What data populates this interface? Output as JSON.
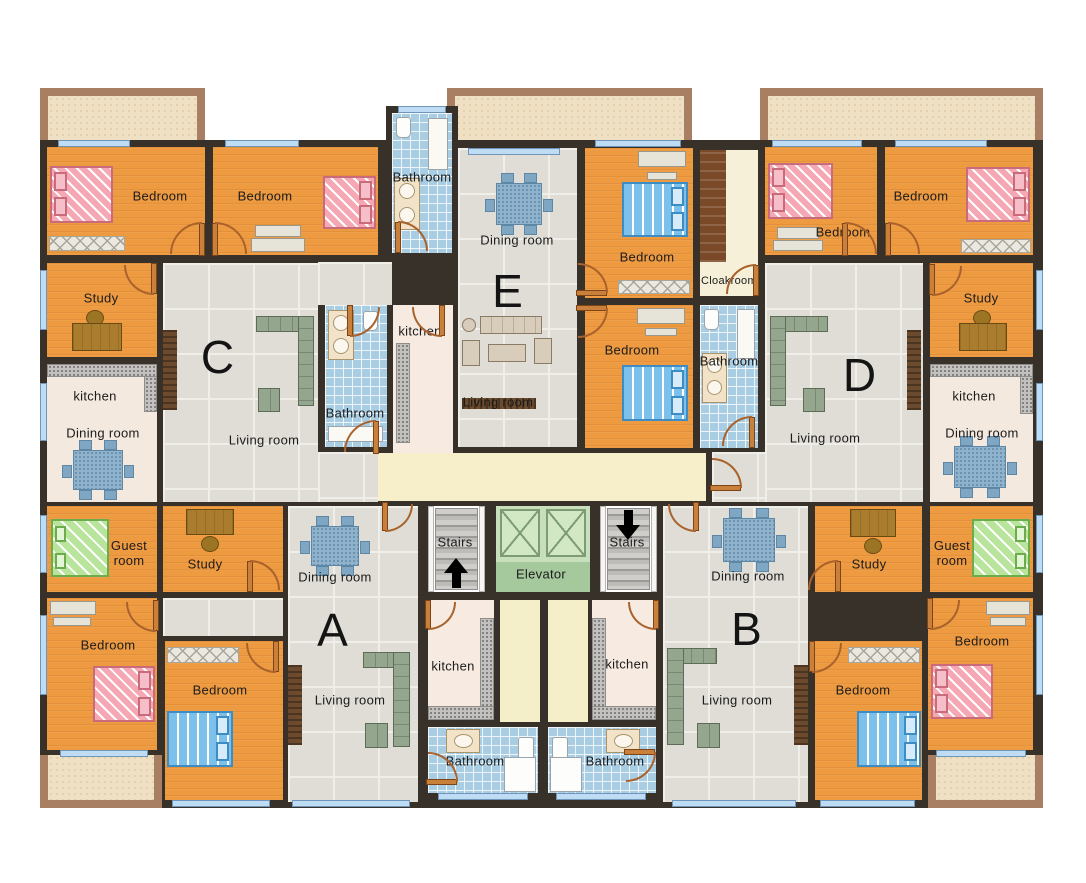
{
  "palette": {
    "wall": "#383129",
    "bedroom_floor": "#EE9A40",
    "tile_floor": "#DFDDD6",
    "kitchen_dining_floor": "#F3E9DF",
    "corridor_floor": "#F6EFC9",
    "bathroom_tile": "#A9CDE3",
    "balcony": "#EFE0C3",
    "balcony_border": "#A97F63",
    "elevator_green": "#C7DFBA",
    "bed_pink": "#F5A8B4",
    "bed_blue": "#7CC0EC",
    "bed_green": "#B8E49C",
    "door_wood": "#C9803A",
    "window_glass": "#BFDCF5"
  },
  "units": {
    "a": "A",
    "b": "B",
    "c": "C",
    "d": "D",
    "e": "E"
  },
  "core": {
    "stairs_left": "Stairs",
    "stairs_right": "Stairs",
    "elevator": "Elevator"
  },
  "icons": {
    "stairs_up_arrow": "up-arrow",
    "stairs_down_arrow": "down-arrow"
  },
  "rooms": {
    "c_bedroom1": "Bedroom",
    "c_bedroom2": "Bedroom",
    "c_bathroom_top": "Bathroom",
    "c_study": "Study",
    "c_kitchen": "kitchen",
    "c_dining": "Dining room",
    "c_living": "Living room",
    "c_bathroom": "Bathroom",
    "c_guest": "Guest room",
    "e_dining": "Dining room",
    "e_kitchen": "kitchen",
    "e_living": "Living room",
    "e_bedroom1": "Bedroom",
    "e_bedroom2": "Bedroom",
    "e_cloakroom": "Cloakroom",
    "e_bathroom": "Bathroom",
    "d_bedroom1": "Bedroom",
    "d_bedroom2": "Bedroom",
    "d_study": "Study",
    "d_kitchen": "kitchen",
    "d_dining": "Dining room",
    "d_living": "Living room",
    "d_guest": "Guest room",
    "a_study": "Study",
    "a_dining": "Dining room",
    "a_living": "Living room",
    "a_bedroom1": "Bedroom",
    "a_bedroom2": "Bedroom",
    "a_kitchen": "kitchen",
    "a_bathroom": "Bathroom",
    "b_dining": "Dining room",
    "b_living": "Living room",
    "b_study": "Study",
    "b_bedroom1": "Bedroom",
    "b_bedroom2": "Bedroom",
    "b_kitchen": "kitchen",
    "b_bathroom": "Bathroom"
  }
}
